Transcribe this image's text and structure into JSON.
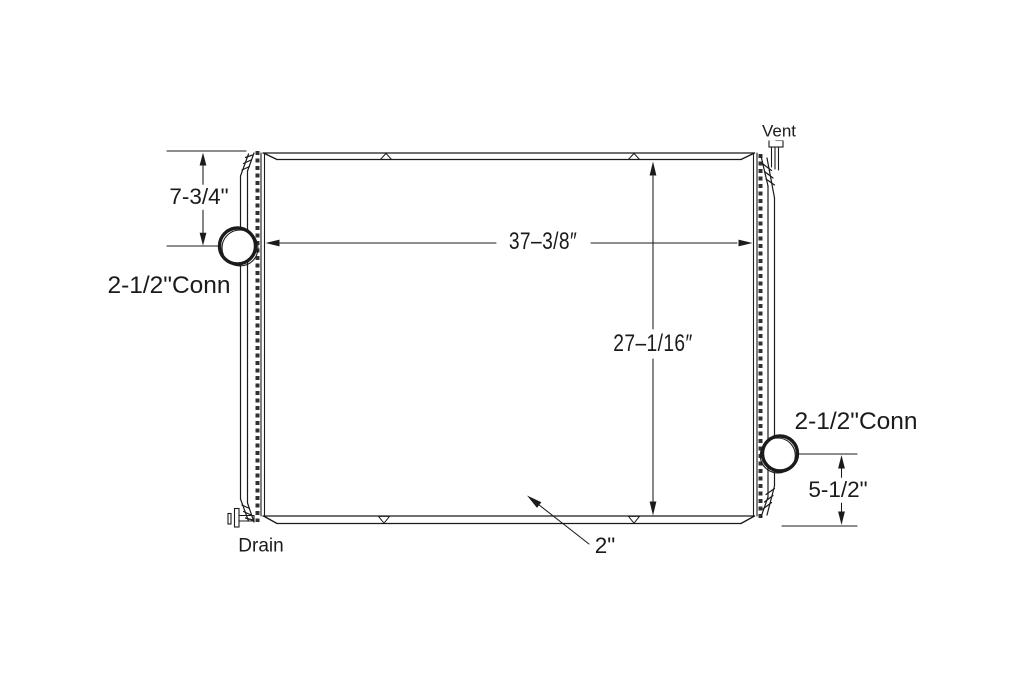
{
  "drawing": {
    "labels": {
      "vent": "Vent",
      "drain": "Drain",
      "conn_left": "2-1/2\"Conn",
      "conn_right": "2-1/2\"Conn",
      "dim_inlet": "7-3/4\"",
      "dim_width": "37–3/8″",
      "dim_core_height": "27–1/16″",
      "dim_outlet": "5-1/2\"",
      "dim_core_depth": "2\""
    },
    "colors": {
      "line": "#1b1b1b",
      "background": "#ffffff"
    }
  }
}
